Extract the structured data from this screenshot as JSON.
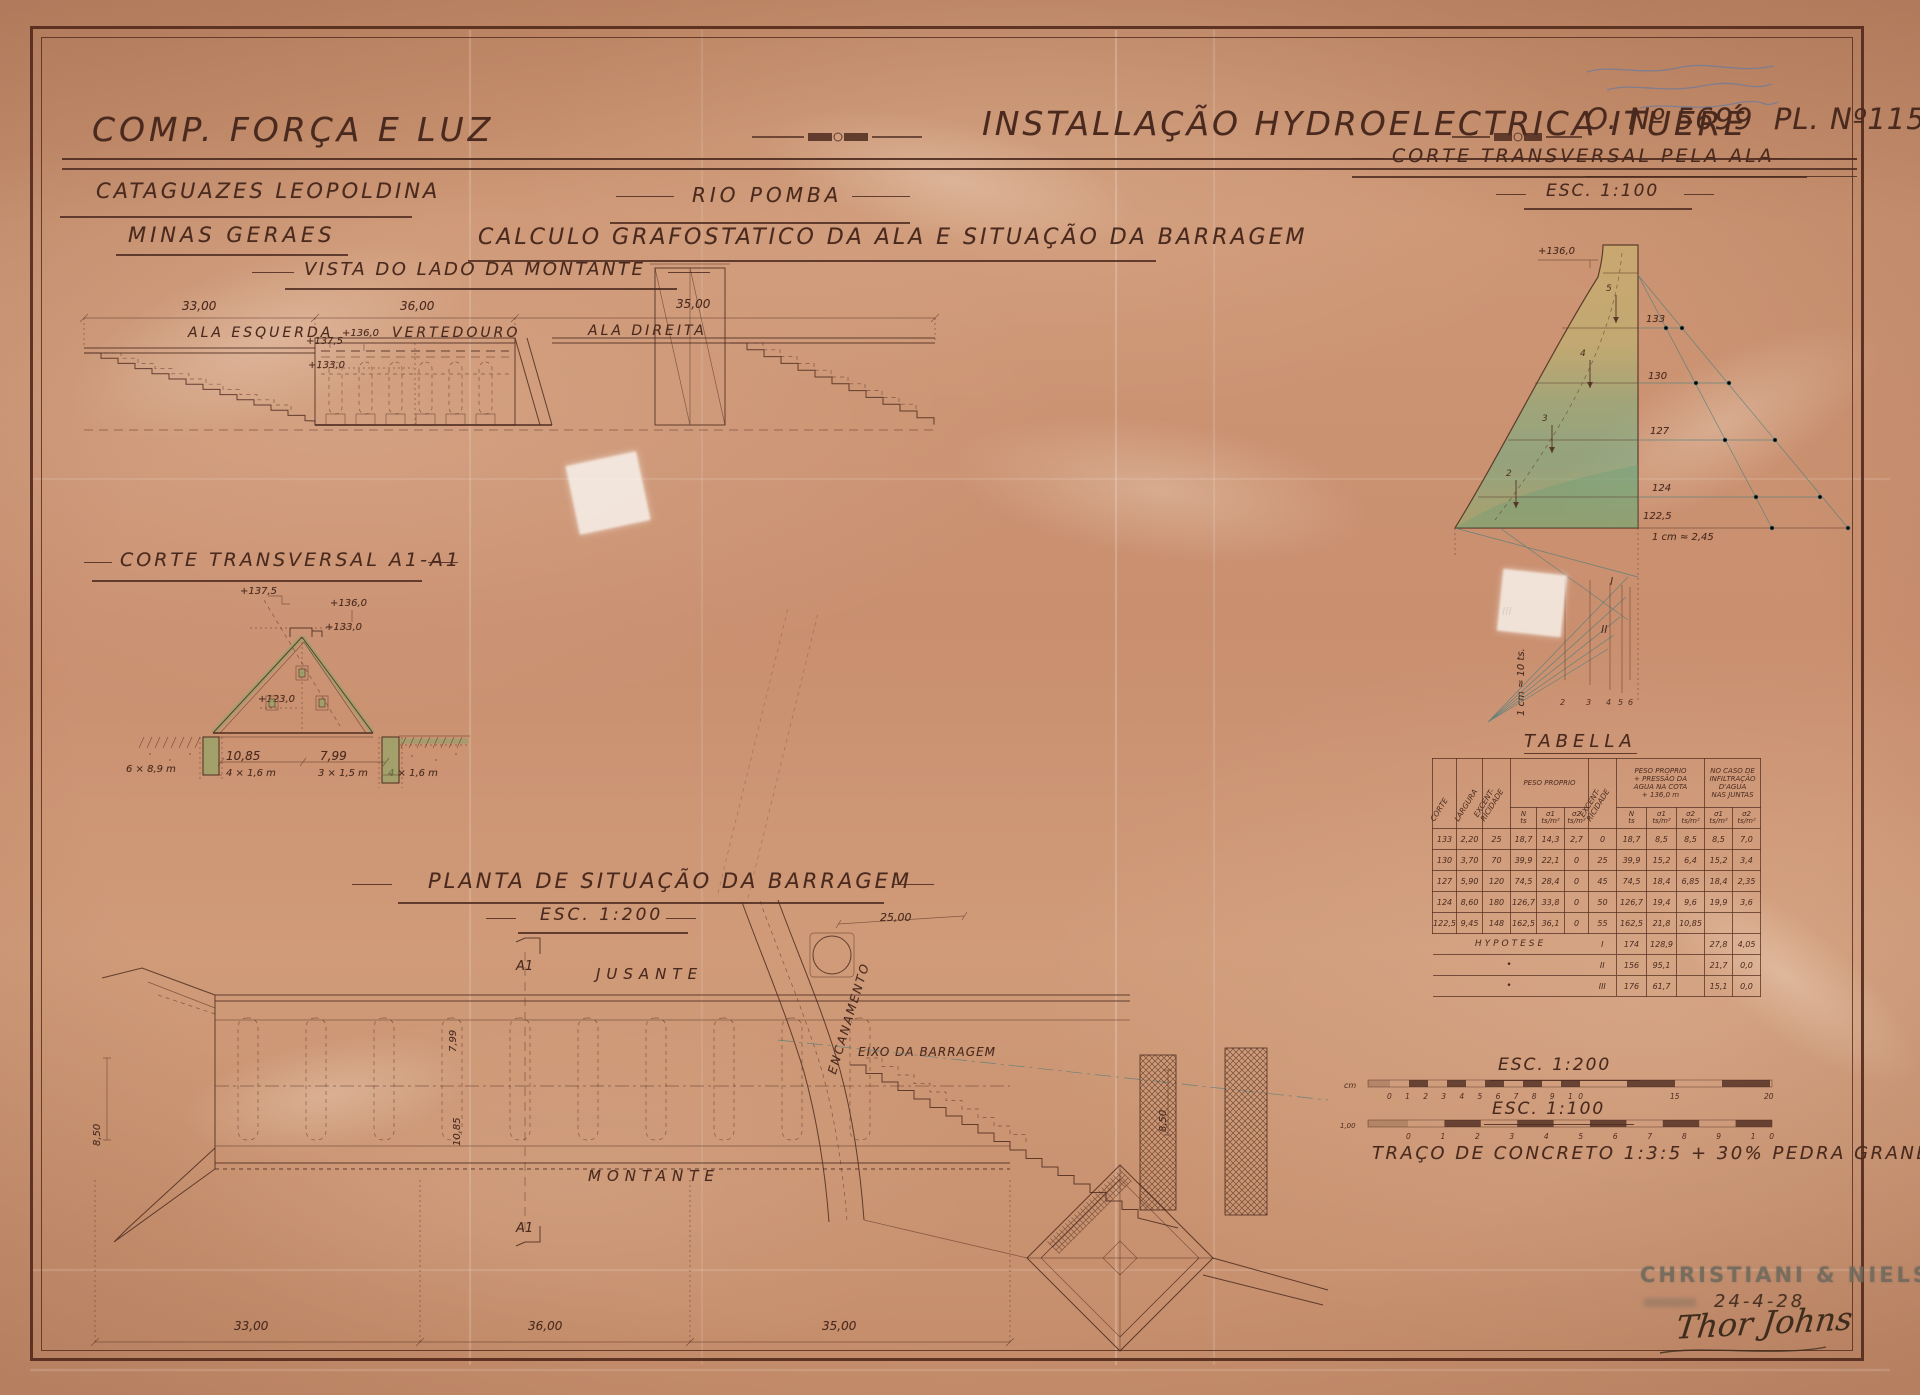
{
  "header": {
    "company": "COMP. FORÇA E LUZ",
    "location_line1": "CATAGUAZES LEOPOLDINA",
    "location_line2": "MINAS GERAES",
    "main_title": "INSTALLAÇÃO HYDROELECTRICA ITUERÉ",
    "river": "RIO POMBA",
    "subject": "CALCULO GRAFOSTATICO DA ALA E SITUAÇÃO DA BARRAGEM",
    "order_number": "O. Nº 5699  PL. Nº115"
  },
  "annotation": {
    "ink": "blue",
    "legible": false
  },
  "vista": {
    "title": "VISTA DO LADO DA MONTANTE",
    "dims": [
      "33,00",
      "36,00",
      "35,00"
    ],
    "labels": [
      "ALA ESQUERDA",
      "VERTEDOURO",
      "ALA DIREITA"
    ],
    "elevations": [
      "+137,5",
      "+136,0",
      "+133,0"
    ]
  },
  "corte_a1": {
    "title": "CORTE TRANSVERSAL A1-A1",
    "elevations": [
      "+137,5",
      "+136,0",
      "+133,0",
      "+123,0"
    ],
    "dims": [
      "10,85",
      "7,99"
    ],
    "notes": [
      "6 × 8,9 m",
      "4 × 1,6 m",
      "3 × 1,5 m",
      "4 × 1,6 m"
    ]
  },
  "planta": {
    "title": "PLANTA DE SITUAÇÃO DA BARRAGEM",
    "scale": "ESC. 1:200",
    "label_jusante": "JUSANTE",
    "label_montante": "MONTANTE",
    "label_encanamento": "ENCANAMENTO",
    "label_eixo": "EIXO DA BARRAGEM",
    "section_marker": "A1",
    "dims_bottom": [
      "33,00",
      "36,00",
      "35,00"
    ],
    "dim_left": "8,50",
    "dim_right": "8,50",
    "dim_top": "25,00",
    "dims_rotated": [
      "7,99",
      "10,85"
    ]
  },
  "corte_ala": {
    "title": "CORTE TRANSVERSAL PELA ALA",
    "scale": "ESC. 1:100",
    "elevation_crest": "+136,0",
    "levels": [
      "133",
      "130",
      "127",
      "124",
      "122,5"
    ],
    "scale_note": "1 cm ≈ 2,45",
    "force_scale_note": "1 cm ≈ 10 ts.",
    "force_numbers": [
      "5",
      "4",
      "3",
      "2"
    ],
    "polygon_numbers": [
      "2",
      "3",
      "4",
      "5",
      "6"
    ],
    "hypothesis_numerals": [
      "I",
      "II",
      "III"
    ]
  },
  "tabella": {
    "title": "TABELLA",
    "col_corte": "CORTE",
    "col_largura": "LARGURA",
    "col_excentricidade": "EXCENT-\nRICIDADE",
    "group_peso": "PESO PROPRIO",
    "group_peso_agua": "PESO PROPRIO\n+ PRESSÃO DA\nAGUA NA COTA\n+ 136,0 m",
    "group_infiltracao": "NO CASO DE\nINFILTRAÇÃO\nD'AGUA\nNAS JUNTAS",
    "sub_n": "N\nts",
    "sub_s1": "σ1\nts/m²",
    "sub_s2": "σ2\nts/m²",
    "rows": [
      [
        "133",
        "2,20",
        "25",
        "18,7",
        "14,3",
        "2,7",
        "0",
        "18,7",
        "8,5",
        "8,5",
        "8,5",
        "7,0"
      ],
      [
        "130",
        "3,70",
        "70",
        "39,9",
        "22,1",
        "0",
        "25",
        "39,9",
        "15,2",
        "6,4",
        "15,2",
        "3,4"
      ],
      [
        "127",
        "5,90",
        "120",
        "74,5",
        "28,4",
        "0",
        "45",
        "74,5",
        "18,4",
        "6,85",
        "18,4",
        "2,35"
      ],
      [
        "124",
        "8,60",
        "180",
        "126,7",
        "33,8",
        "0",
        "50",
        "126,7",
        "19,4",
        "9,6",
        "19,9",
        "3,6"
      ],
      [
        "122,5",
        "9,45",
        "148",
        "162,5",
        "36,1",
        "0",
        "55",
        "162,5",
        "21,8",
        "10,85",
        "",
        ""
      ]
    ],
    "hypo": [
      {
        "label": "HYPOTESE",
        "num": "I",
        "n": "174",
        "s1": "128,9",
        "s2": "",
        "i1": "27,8",
        "i2": "4,05"
      },
      {
        "label": "•",
        "num": "II",
        "n": "156",
        "s1": "95,1",
        "s2": "",
        "i1": "21,7",
        "i2": "0,0"
      },
      {
        "label": "•",
        "num": "III",
        "n": "176",
        "s1": "61,7",
        "s2": "",
        "i1": "15,1",
        "i2": "0,0"
      }
    ]
  },
  "scalebars": {
    "esc200": "ESC. 1:200",
    "esc100": "ESC. 1:100",
    "b1_unit": "cm",
    "b1_nums": "0 1 2 3 4 5 6 7 8 9 10",
    "b1_mid": "15",
    "b1_end": "20",
    "b2_unit": "1,00",
    "b2_nums": "0 1 2 3 4 5 6 7 8 9 10",
    "concrete_note": "TRAÇO DE CONCRETO 1:3:5 + 30% PEDRA GRANDE"
  },
  "stamp": {
    "company": "CHRISTIANI & NIELSEN",
    "date": "24-4-28",
    "signature": "Thor Johns"
  },
  "colors": {
    "paper": "#c98f6f",
    "ink": "#4e2c20",
    "frame": "#5c2f22",
    "construction_teal": "#4e7d7d",
    "wash_green": "#7fa868",
    "wash_yellow": "#c8bd6d",
    "stamp_gray": "#7e786b",
    "blue_ink": "#5878aa"
  }
}
